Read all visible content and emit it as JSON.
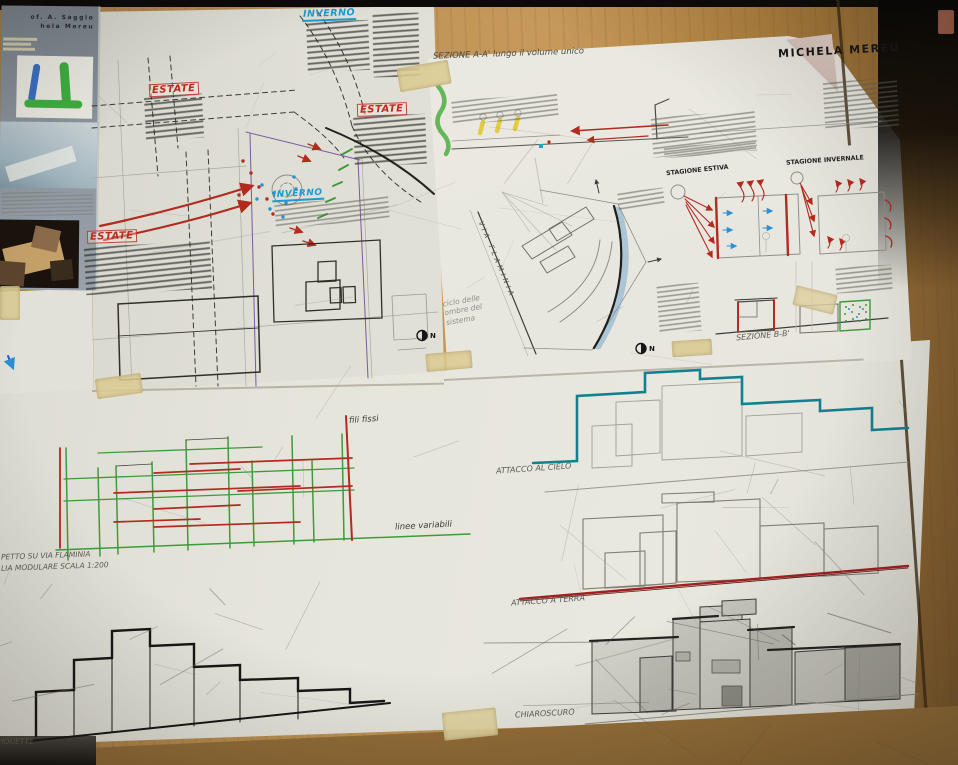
{
  "signature": "MICHELA MEREU",
  "poster": {
    "credit1": "of.  A.  Saggio",
    "credit2": "hela     Mereu"
  },
  "plan": {
    "inverno_top": "INVERNO",
    "estate_left": "ESTATE",
    "estate_right": "ESTATE",
    "estate_lower": "ESTATE",
    "inverno_mid": "INVERNO"
  },
  "sections": {
    "title_aa": "SEZIONE A-A'  lungo il volume unico",
    "via_flaminia": "VIA FLAMINIA",
    "shadow_cycle": "ciclo delle ombre del sistema",
    "stagione_estiva": "STAGIONE ESTIVA",
    "stagione_invernale": "STAGIONE INVERNALE",
    "sezione_bb": "SEZIONE B-B'",
    "north": "N"
  },
  "studies": {
    "fili_fissi": "fili fissi",
    "linee_variabili": "linee variabili",
    "caption_line1": "PETTO SU VIA FLAMINIA",
    "caption_line2": "LIA MODULARE SCALA 1:200",
    "attacco_cielo": "ATTACCO AL CIELO",
    "attacco_terra": "ATTACCO A TERRA",
    "chiaroscuro": "CHIAROSCURO",
    "silhouette": "SILHOUETTE"
  },
  "colors": {
    "marker_red": "#c02a1e",
    "marker_blue": "#1d9ad1",
    "grid_green": "#3f9a3c",
    "grid_red": "#b22a20",
    "teal_outline": "#12808e",
    "ground_line_red": "#a02020",
    "wood": "#b98c4e",
    "paper": "#e6e5dd"
  }
}
